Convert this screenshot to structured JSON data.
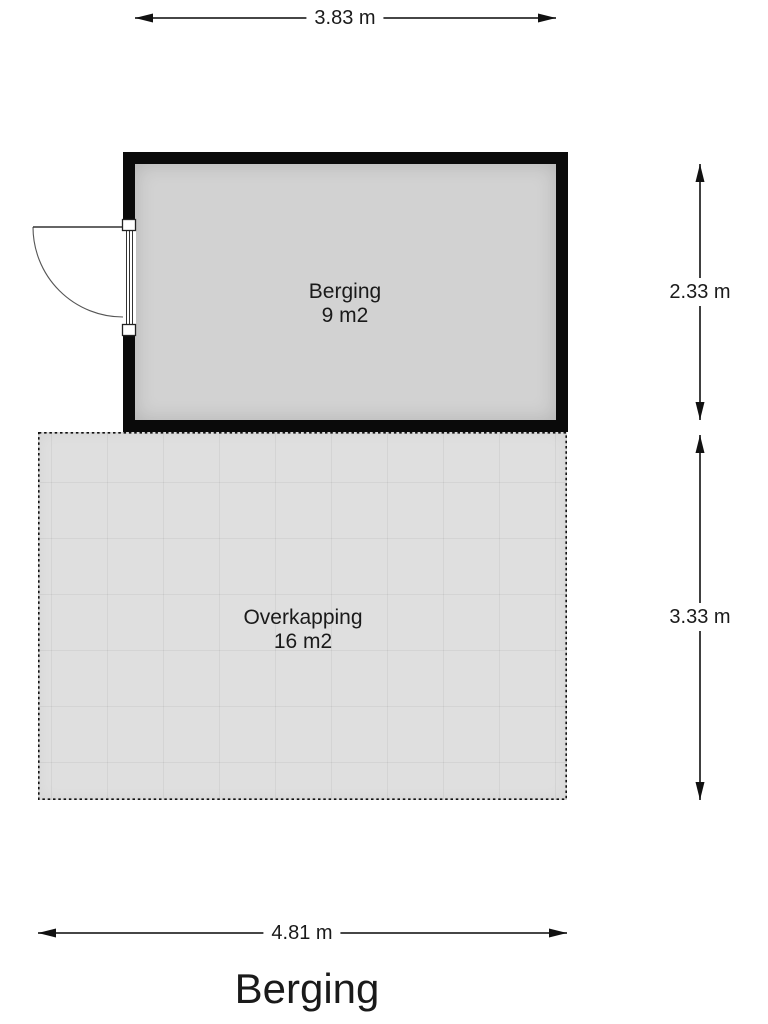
{
  "title": "Berging",
  "rooms": [
    {
      "id": "berging",
      "label": "Berging",
      "area": "9 m2"
    },
    {
      "id": "overkapping",
      "label": "Overkapping",
      "area": "16 m2"
    }
  ],
  "dimensions": {
    "top": "3.83 m",
    "right_upper": "2.33 m",
    "right_lower": "3.33 m",
    "bottom": "4.81 m"
  },
  "icons": {
    "door": "door-swing-icon",
    "arrows": "dimension-arrow-icon"
  },
  "colors": {
    "wall": "#0a0a0a",
    "room_fill": "#d2d2d2",
    "patio_fill": "#dfdfdf",
    "text": "#1a1a1a",
    "dim_line": "#2b2b2b"
  }
}
